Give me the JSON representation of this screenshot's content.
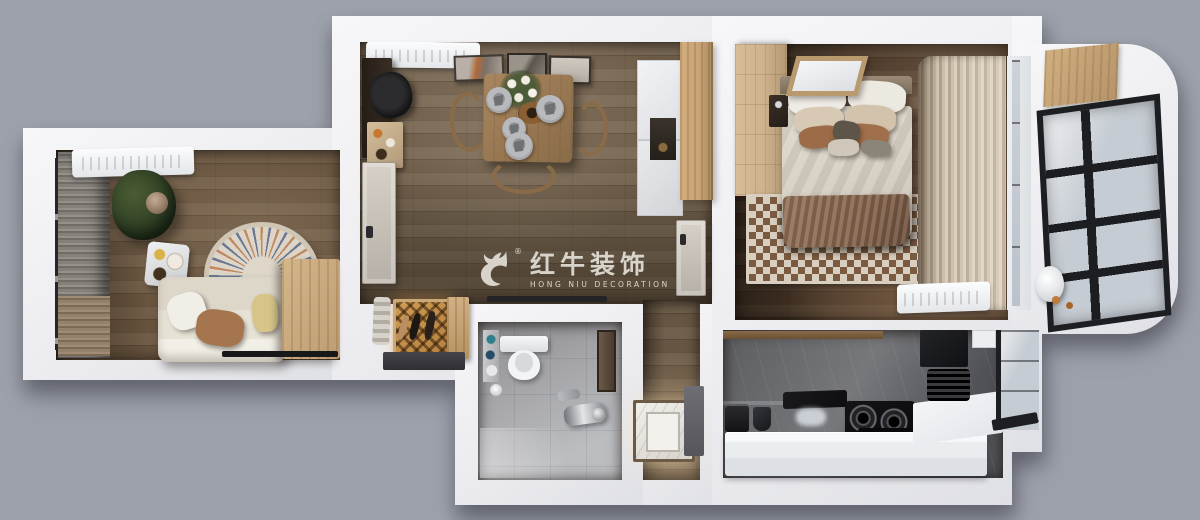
{
  "watermark": {
    "logo_icon": "bull-logo",
    "registered": "®",
    "title_zh": "红牛装饰",
    "subtitle_en": "HONG NIU DECORATION"
  },
  "palette": {
    "bg": "#9da1ab",
    "wall-a": "#f7f7f9",
    "wall-b": "#ececf0",
    "wall-c": "#dfe0e5",
    "wood-living": "#6b5640",
    "wood-dining": "#75634e",
    "wood-bedroom": "#4a3728",
    "wood-cabinet": "#c7a376",
    "wood-oak": "#cdb28c",
    "tile-a": "#8e8e92",
    "tile-b": "#bcbdc1",
    "marble": "#5c5d61",
    "counter": "#e9edf0",
    "black": "#1d1e22",
    "glass": "#c6ccd3",
    "sofa": "#e7e2d6",
    "bedding": "#d5cec2",
    "throw": "#8a6850",
    "amber": "#b3803f",
    "wm": "#efece4"
  }
}
